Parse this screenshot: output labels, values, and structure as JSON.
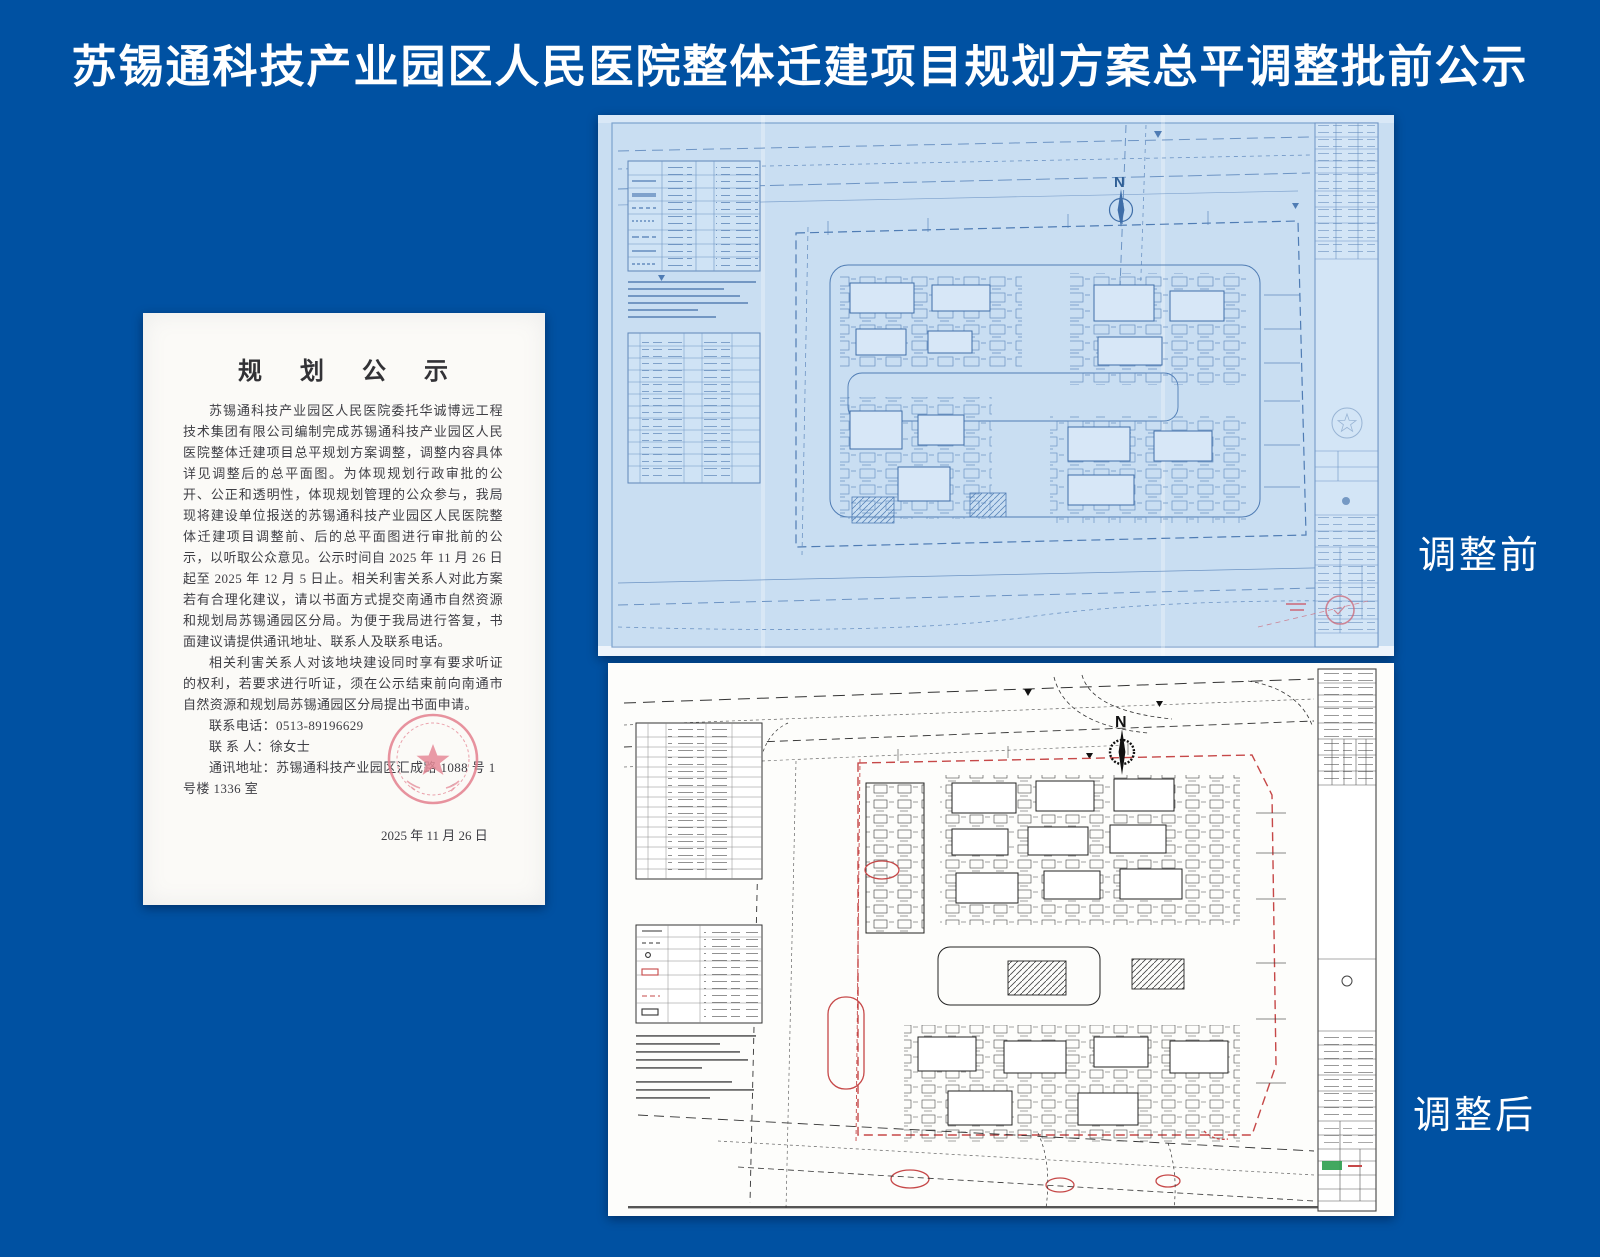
{
  "page": {
    "title": "苏锡通科技产业园区人民医院整体迁建项目规划方案总平调整批前公示",
    "background_color": "#0051a2"
  },
  "document": {
    "title": "规 划 公 示",
    "paragraphs": [
      "苏锡通科技产业园区人民医院委托华诚博远工程技术集团有限公司编制完成苏锡通科技产业园区人民医院整体迁建项目总平规划方案调整，调整内容具体详见调整后的总平面图。为体现规划行政审批的公开、公正和透明性，体现规划管理的公众参与，我局现将建设单位报送的苏锡通科技产业园区人民医院整体迁建项目调整前、后的总平面图进行审批前的公示，以听取公众意见。公示时间自 2025 年 11 月 26 日起至 2025 年 12 月 5 日止。相关利害关系人对此方案若有合理化建议，请以书面方式提交南通市自然资源和规划局苏锡通园区分局。为便于我局进行答复，书面建议请提供通讯地址、联系人及联系电话。",
      "相关利害关系人对该地块建设同时享有要求听证的权利，若要求进行听证，须在公示结束前向南通市自然资源和规划局苏锡通园区分局提出书面申请。"
    ],
    "contact_phone": "联系电话：0513-89196629",
    "contact_person": "联 系 人：徐女士",
    "contact_address": "通讯地址：苏锡通科技产业园区汇成路 1088 号 1 号楼 1336 室",
    "date": "2025 年 11 月 26 日"
  },
  "labels": {
    "before": "调整前",
    "after": "调整后"
  },
  "plans": {
    "north_label": "N"
  },
  "colors": {
    "background": "#0051a2",
    "blueprint_paper": "#c9def2",
    "blueprint_ink": "#5b87bd",
    "plan_paper": "#fdfdfb",
    "plan_ink": "#333333",
    "adjustment_red": "#c64848",
    "seal_red": "#e4808f",
    "stamp_green": "#2e9e4f"
  }
}
